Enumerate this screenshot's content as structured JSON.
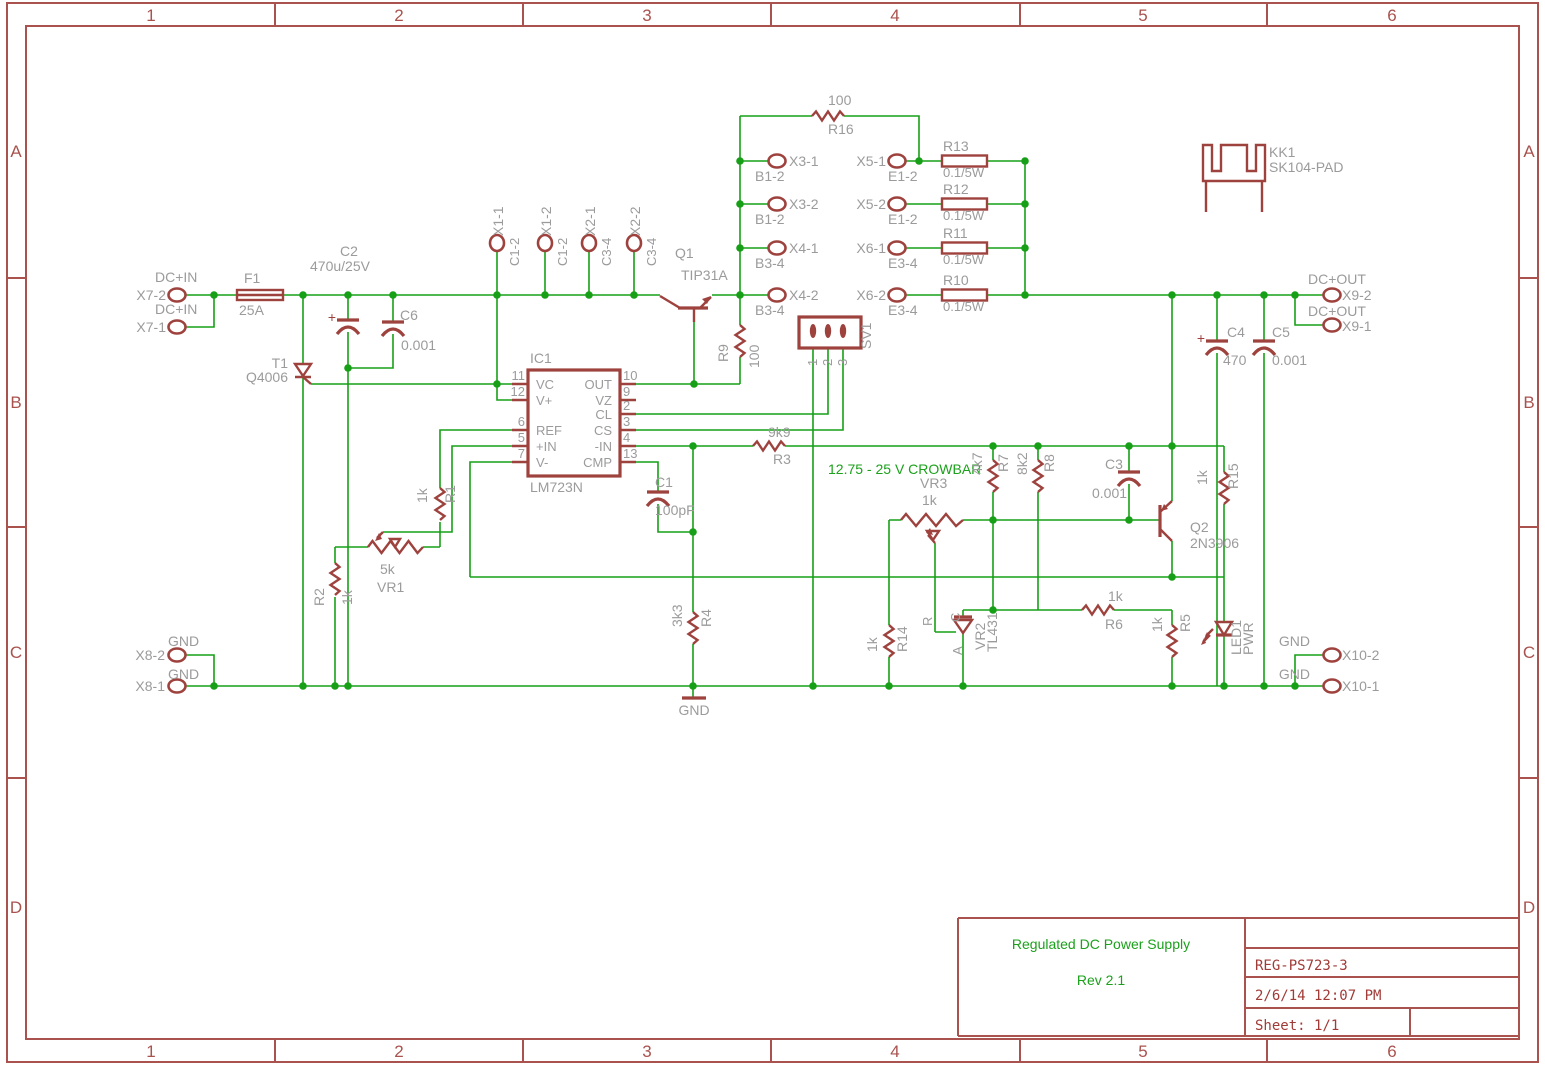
{
  "frame": {
    "columns": [
      "1",
      "2",
      "3",
      "4",
      "5",
      "6"
    ],
    "rows": [
      "A",
      "B",
      "C",
      "D"
    ]
  },
  "title_block": {
    "project": "Regulated DC Power Supply",
    "rev": "Rev 2.1",
    "code": "REG-PS723-3",
    "datetime": "2/6/14 12:07 PM",
    "sheet": "Sheet: 1/1"
  },
  "notes": {
    "crowbar": "12.75 - 25 V CROWBAR",
    "gnd": "GND"
  },
  "pads": {
    "x7_2": {
      "id": "X7-2",
      "net": "DC+IN"
    },
    "x7_1": {
      "id": "X7-1",
      "net": "DC+IN"
    },
    "x8_2": {
      "id": "X8-2",
      "net": "GND"
    },
    "x8_1": {
      "id": "X8-1",
      "net": "GND"
    },
    "x9_2": {
      "id": "X9-2",
      "net": "DC+OUT"
    },
    "x9_1": {
      "id": "X9-1",
      "net": "DC+OUT"
    },
    "x10_2": {
      "id": "X10-2",
      "net": "GND"
    },
    "x10_1": {
      "id": "X10-1",
      "net": "GND"
    },
    "x1_1": {
      "id": "X1-1",
      "net": "C1-2"
    },
    "x1_2": {
      "id": "X1-2",
      "net": "C1-2"
    },
    "x2_1": {
      "id": "X2-1",
      "net": "C3-4"
    },
    "x2_2": {
      "id": "X2-2",
      "net": "C3-4"
    },
    "x3_1": {
      "id": "X3-1",
      "net": "B1-2"
    },
    "x3_2": {
      "id": "X3-2",
      "net": "B1-2"
    },
    "x4_1": {
      "id": "X4-1",
      "net": "B3-4"
    },
    "x4_2": {
      "id": "X4-2",
      "net": "B3-4"
    },
    "x5_1": {
      "id": "X5-1",
      "net": "E1-2"
    },
    "x5_2": {
      "id": "X5-2",
      "net": "E1-2"
    },
    "x6_1": {
      "id": "X6-1",
      "net": "E3-4"
    },
    "x6_2": {
      "id": "X6-2",
      "net": "E3-4"
    }
  },
  "components": {
    "f1": {
      "name": "F1",
      "value": "25A"
    },
    "c1": {
      "name": "C1",
      "value": "100pF"
    },
    "c2": {
      "name": "C2",
      "value": "470u/25V",
      "polarity": "+"
    },
    "c3": {
      "name": "C3",
      "value": "0.001"
    },
    "c4": {
      "name": "C4",
      "value": "470",
      "polarity": "+"
    },
    "c5": {
      "name": "C5",
      "value": "0.001"
    },
    "c6": {
      "name": "C6",
      "value": "0.001"
    },
    "t1": {
      "name": "T1",
      "value": "Q4006"
    },
    "q1": {
      "name": "Q1",
      "value": "TIP31A"
    },
    "q2": {
      "name": "Q2",
      "value": "2N3906"
    },
    "r1": {
      "name": "R1",
      "value": "1k"
    },
    "r2": {
      "name": "R2",
      "value": "1k"
    },
    "r3": {
      "name": "R3",
      "value": "9k9"
    },
    "r4": {
      "name": "R4",
      "value": "3k3"
    },
    "r5": {
      "name": "R5",
      "value": "1k"
    },
    "r6": {
      "name": "R6",
      "value": "1k"
    },
    "r7": {
      "name": "R7",
      "value": "4k7"
    },
    "r8": {
      "name": "R8",
      "value": "8k2"
    },
    "r9": {
      "name": "R9",
      "value": "100"
    },
    "r10": {
      "name": "R10",
      "value": "0.1/5W"
    },
    "r11": {
      "name": "R11",
      "value": "0.1/5W"
    },
    "r12": {
      "name": "R12",
      "value": "0.1/5W"
    },
    "r13": {
      "name": "R13",
      "value": "0.1/5W"
    },
    "r14": {
      "name": "R14",
      "value": "1k"
    },
    "r15": {
      "name": "R15",
      "value": "1k"
    },
    "r16": {
      "name": "R16",
      "value": "100"
    },
    "vr1": {
      "name": "VR1",
      "value": "5k"
    },
    "vr2": {
      "name": "VR2",
      "value": "TL431",
      "pins": [
        "R",
        "C",
        "A"
      ]
    },
    "vr3": {
      "name": "VR3",
      "value": "1k"
    },
    "led1": {
      "name": "LED1",
      "value": "PWR"
    },
    "kk1": {
      "name": "KK1",
      "value": "SK104-PAD"
    },
    "sv1": {
      "name": "SV1",
      "pins": [
        "1",
        "2",
        "3"
      ]
    },
    "ic1": {
      "name": "IC1",
      "value": "LM723N",
      "pins_left": [
        {
          "num": "11",
          "name": "VC"
        },
        {
          "num": "12",
          "name": "V+"
        },
        {
          "num": "6",
          "name": "REF"
        },
        {
          "num": "5",
          "name": "+IN"
        },
        {
          "num": "7",
          "name": "V-"
        }
      ],
      "pins_right": [
        {
          "num": "10",
          "name": "OUT"
        },
        {
          "num": "9",
          "name": "VZ"
        },
        {
          "num": "2",
          "name": "CL"
        },
        {
          "num": "3",
          "name": "CS"
        },
        {
          "num": "4",
          "name": "-IN"
        },
        {
          "num": "13",
          "name": "CMP"
        }
      ]
    }
  }
}
